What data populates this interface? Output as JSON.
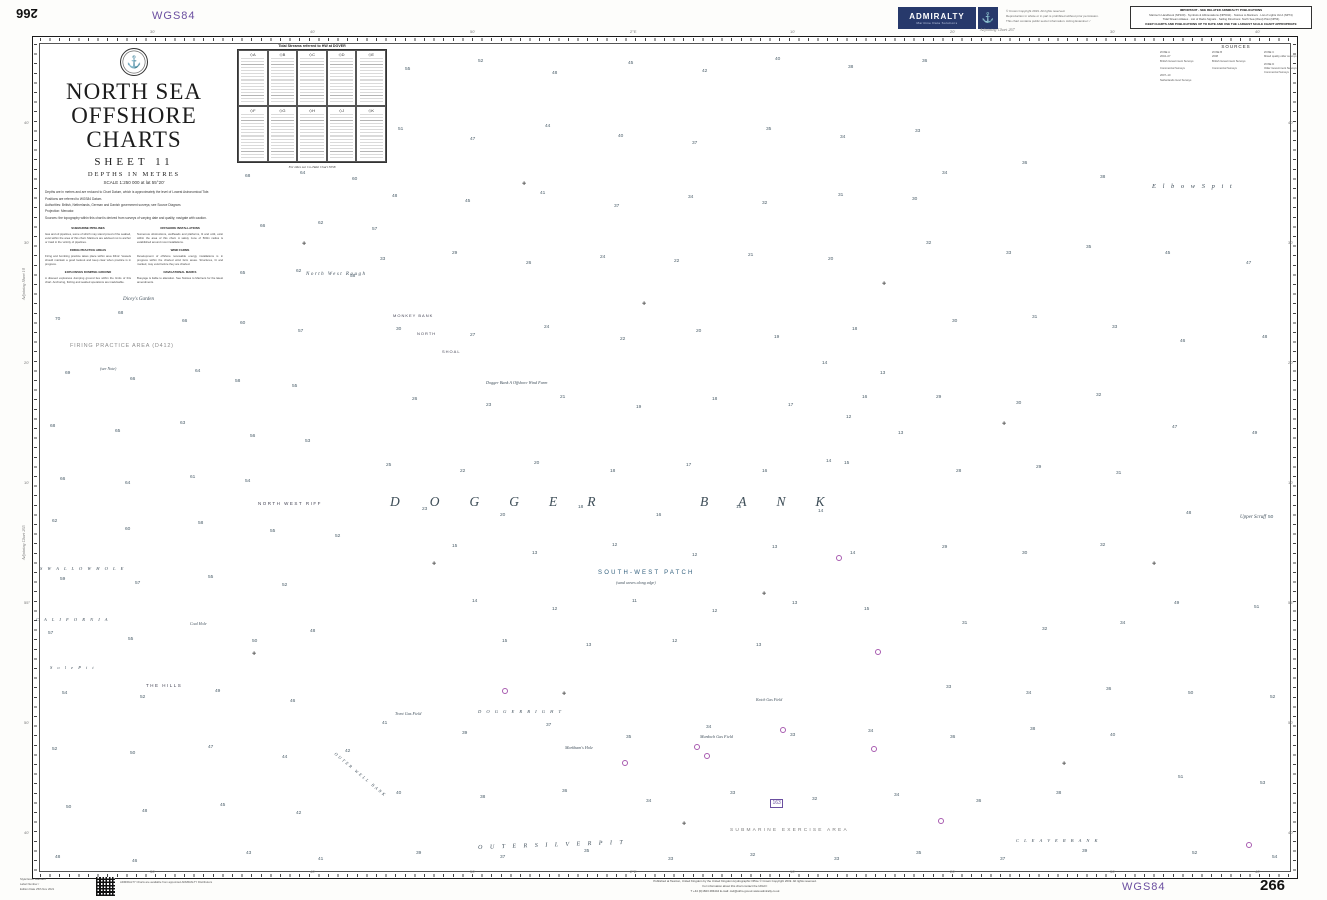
{
  "colors": {
    "navy": "#27396b",
    "purple": "#6b4fa0",
    "magenta": "#a85bb0",
    "w1": "#d9edf8",
    "w2": "#bfe2f4",
    "w3": "#a3d4ee"
  },
  "chart": {
    "number": "266",
    "datum": "WGS84",
    "title_line1": "NORTH SEA",
    "title_line2": "OFFSHORE CHARTS",
    "sheet": "SHEET  11",
    "depths": "DEPTHS IN METRES",
    "scale": "SCALE 1:250 000 at lat 55°20'",
    "notes_para": [
      "Depths are in metres and are reduced to Chart Datum, which is approximately the level of Lowest Astronomical Tide.",
      "Positions are referred to WGS84 Datum.",
      "Authorities: British, Netherlands, German and Danish government surveys; see Source Diagram.",
      "Projection: Mercator.",
      "Sources: the topography within this chart is derived from surveys of varying date and quality; navigate with caution."
    ],
    "notes_left": [
      {
        "h": "SUBMARINE PIPELINES",
        "b": "Gas and oil pipelines, some of which may stand proud of the seabed, exist within the area of this chart. Mariners are advised not to anchor or trawl in the vicinity of pipelines."
      },
      {
        "h": "FIRING PRACTICE AREAS",
        "b": "Firing and bombing practice takes place within area D412. Vessels should maintain a good lookout and keep clear when practice is in progress."
      },
      {
        "h": "EXPLOSIVES DUMPING GROUND",
        "b": "A disused explosives dumping ground lies within the limits of this chart. Anchoring, fishing and seabed operations are inadvisable."
      }
    ],
    "notes_right": [
      {
        "h": "OFFSHORE INSTALLATIONS",
        "b": "Numerous obstructions, wellheads and platforms, lit and unlit, exist within the area of this chart. A safety zone of 500m radius is established around most installations."
      },
      {
        "h": "WIND FARMS",
        "b": "Development of offshore renewable energy installations is in progress within the charted wind farm areas. Structures, lit and marked, may exist before they are charted."
      },
      {
        "h": "NAVIGATIONAL MARKS",
        "b": "Buoyage is liable to alteration. See Notices to Mariners for the latest amendments."
      }
    ]
  },
  "header": {
    "badge_label": "ADMIRALTY",
    "badge_sub": "Maritime Data Solutions",
    "anchor_glyph": "⚓",
    "copyright_lines": [
      "© Crown Copyright 2019. All rights reserved.",
      "Reproduction in whole or in part is prohibited without prior permission.",
      "This chart contains public sector information. Acting Examiner: /"
    ],
    "important": {
      "header": "IMPORTANT - SEE RELATED ADMIRALTY PUBLICATIONS",
      "lines": [
        "Mariner's Handbook (NP100) · Symbols & Abbreviations (NP5011) · Notices to Mariners · List of Lights Vol A (NP74)",
        "Tidal Stream Atlases · List of Radio Signals · Sailing Directions: North Sea (West) Pilot (NP54)"
      ],
      "footer": "KEEP CHARTS AND PUBLICATIONS UP TO DATE AND USE THE LARGEST SCALE CHART APPROPRIATE"
    }
  },
  "tidal_table": {
    "title": "Tidal Streams referred to HW at DOVER",
    "stations": [
      "A",
      "B",
      "C",
      "D",
      "E",
      "F",
      "G",
      "H",
      "J",
      "K"
    ],
    "footer": "For tides see Co-Tidal Chart 5058"
  },
  "sources": {
    "title": "SOURCES",
    "columns": [
      [
        "ZONE A",
        "2004–07",
        "British Government Surveys",
        "",
        "Commercial Surveys",
        "",
        "2007–10",
        "Netherlands Govt Surveys"
      ],
      [
        "ZONE B",
        "2008",
        "British Government Surveys",
        "",
        "Commercial Surveys"
      ],
      [
        "ZONE C",
        "Mixed quality older surveys",
        "",
        "ZONE D",
        "Older Government Surveys",
        "Commercial Surveys"
      ]
    ]
  },
  "footer": {
    "bottom_left_lines": [
      "Style/Issue      Standard",
      "Label Number   /",
      "Edition Date     25th Nov 2021"
    ],
    "qr_note": "ADMIRALTY Charts are available from appointed ADMIRALTY Distributors",
    "pub_lines": [
      "Published at Taunton, United Kingdom by the United Kingdom Hydrographic Office © Crown Copyright 2019. All rights reserved.",
      "For information about this chart contact the UKHO:",
      "T +44 (0)1823 484444          E-mail: csd@ukho.gov.uk          www.admiralty.co.uk"
    ]
  },
  "geo_labels": [
    {
      "t": "North West Rough",
      "x": 306,
      "y": 272,
      "c": "it5sp"
    },
    {
      "t": "MONKEY BANK",
      "x": 393,
      "y": 314,
      "c": "cap4"
    },
    {
      "t": "NORTH",
      "x": 417,
      "y": 332,
      "c": "cap4"
    },
    {
      "t": "SHOAL",
      "x": 442,
      "y": 350,
      "c": "cap4"
    },
    {
      "t": "Dicey's Garden",
      "x": 123,
      "y": 297,
      "c": "it5"
    },
    {
      "t": "FIRING PRACTICE AREA (D412)",
      "x": 70,
      "y": 344,
      "c": "area"
    },
    {
      "t": "(see Note)",
      "x": 100,
      "y": 367,
      "c": "it4"
    },
    {
      "t": "NORTH WEST RIFF",
      "x": 258,
      "y": 502,
      "c": "cap5sp"
    },
    {
      "t": "DOGGER",
      "x": 390,
      "y": 495,
      "c": "dogger"
    },
    {
      "t": "BANK",
      "x": 700,
      "y": 495,
      "c": "dogger"
    },
    {
      "t": "Dogger Bank A Offshore Wind Farm",
      "x": 486,
      "y": 381,
      "c": "it42"
    },
    {
      "t": "SOUTH-WEST PATCH",
      "x": 598,
      "y": 570,
      "c": "swp"
    },
    {
      "t": "(sand waves along edge)",
      "x": 616,
      "y": 581,
      "c": "it4"
    },
    {
      "t": "E l b o w   S p i t",
      "x": 1152,
      "y": 184,
      "c": "elbow"
    },
    {
      "t": "Upper Scruff",
      "x": 1240,
      "y": 515,
      "c": "it5"
    },
    {
      "t": "S W A L L O W   H O L E",
      "x": 40,
      "y": 567,
      "c": "itsp"
    },
    {
      "t": "C A L I F O R N I A",
      "x": 36,
      "y": 618,
      "c": "itsp"
    },
    {
      "t": "S o l e   P i t",
      "x": 50,
      "y": 666,
      "c": "itsp"
    },
    {
      "t": "Coal Hole",
      "x": 190,
      "y": 622,
      "c": "it4"
    },
    {
      "t": "THE HILLS",
      "x": 146,
      "y": 684,
      "c": "cap5sp"
    },
    {
      "t": "Trent Gas Field",
      "x": 395,
      "y": 712,
      "c": "it42"
    },
    {
      "t": "D O G G E R   B I G H T",
      "x": 478,
      "y": 710,
      "c": "itsp"
    },
    {
      "t": "Markham's Hole",
      "x": 565,
      "y": 746,
      "c": "it42"
    },
    {
      "t": "Murdoch Gas Field",
      "x": 700,
      "y": 735,
      "c": "it42"
    },
    {
      "t": "Ketch Gas Field",
      "x": 756,
      "y": 698,
      "c": "it4"
    },
    {
      "t": "SUBMARINE EXERCISE AREA",
      "x": 730,
      "y": 829,
      "c": "exer"
    },
    {
      "t": "O U T E R   S I L V E R   P I T",
      "x": 478,
      "y": 845,
      "c": "itsp6",
      "r": -2
    },
    {
      "t": "C L E A V E R   B A N K",
      "x": 1016,
      "y": 839,
      "c": "itsp"
    },
    {
      "t": "OUTER WELL BANK",
      "x": 336,
      "y": 752,
      "c": "cap4sp",
      "r": 40
    },
    {
      "t": "163",
      "x": 770,
      "y": 799,
      "c": "chartref"
    },
    {
      "t": "Adjoining Chart 267",
      "x": 980,
      "y": 28,
      "c": "adj"
    },
    {
      "t": "Adjoining Chart 265",
      "x": 22,
      "y": 560,
      "c": "adj",
      "r": -90
    },
    {
      "t": "Adjoining Sheet 10",
      "x": 22,
      "y": 300,
      "c": "adj",
      "r": -90
    }
  ],
  "border": {
    "top": [
      {
        "x": 150,
        "t": "30'"
      },
      {
        "x": 310,
        "t": "40'"
      },
      {
        "x": 470,
        "t": "50'"
      },
      {
        "x": 630,
        "t": "2°E"
      },
      {
        "x": 790,
        "t": "10'"
      },
      {
        "x": 950,
        "t": "20'"
      },
      {
        "x": 1110,
        "t": "30'"
      },
      {
        "x": 1255,
        "t": "40'"
      }
    ],
    "left": [
      {
        "y": 120,
        "t": "40'"
      },
      {
        "y": 240,
        "t": "30'"
      },
      {
        "y": 360,
        "t": "20'"
      },
      {
        "y": 480,
        "t": "10'"
      },
      {
        "y": 600,
        "t": "55°"
      },
      {
        "y": 720,
        "t": "50'"
      },
      {
        "y": 830,
        "t": "40'"
      }
    ]
  },
  "symbols": {
    "wrecks": [
      [
        302,
        242
      ],
      [
        522,
        182
      ],
      [
        642,
        302
      ],
      [
        432,
        562
      ],
      [
        762,
        592
      ],
      [
        562,
        692
      ],
      [
        882,
        282
      ],
      [
        1002,
        422
      ],
      [
        1152,
        562
      ],
      [
        252,
        652
      ],
      [
        682,
        822
      ],
      [
        1062,
        762
      ]
    ],
    "platforms": [
      [
        836,
        555
      ],
      [
        875,
        649
      ],
      [
        694,
        744
      ],
      [
        704,
        753
      ],
      [
        780,
        727
      ],
      [
        871,
        746
      ],
      [
        938,
        818
      ],
      [
        502,
        688
      ],
      [
        622,
        760
      ],
      [
        1246,
        842
      ]
    ]
  },
  "soundings": [
    [
      245,
      175,
      "68"
    ],
    [
      300,
      172,
      "64"
    ],
    [
      352,
      178,
      "60"
    ],
    [
      260,
      225,
      "66"
    ],
    [
      318,
      222,
      "62"
    ],
    [
      372,
      228,
      "57"
    ],
    [
      240,
      272,
      "65"
    ],
    [
      296,
      270,
      "62"
    ],
    [
      350,
      275,
      "58"
    ],
    [
      55,
      318,
      "70"
    ],
    [
      118,
      312,
      "68"
    ],
    [
      182,
      320,
      "66"
    ],
    [
      65,
      372,
      "69"
    ],
    [
      130,
      378,
      "66"
    ],
    [
      195,
      370,
      "64"
    ],
    [
      50,
      425,
      "68"
    ],
    [
      115,
      430,
      "65"
    ],
    [
      180,
      422,
      "63"
    ],
    [
      60,
      478,
      "66"
    ],
    [
      125,
      482,
      "64"
    ],
    [
      190,
      476,
      "61"
    ],
    [
      240,
      322,
      "60"
    ],
    [
      298,
      330,
      "57"
    ],
    [
      235,
      380,
      "58"
    ],
    [
      292,
      385,
      "55"
    ],
    [
      250,
      435,
      "56"
    ],
    [
      305,
      440,
      "53"
    ],
    [
      245,
      480,
      "54"
    ],
    [
      52,
      520,
      "62"
    ],
    [
      125,
      528,
      "60"
    ],
    [
      198,
      522,
      "58"
    ],
    [
      270,
      530,
      "55"
    ],
    [
      335,
      535,
      "52"
    ],
    [
      60,
      578,
      "59"
    ],
    [
      135,
      582,
      "57"
    ],
    [
      208,
      576,
      "55"
    ],
    [
      282,
      584,
      "52"
    ],
    [
      48,
      632,
      "57"
    ],
    [
      128,
      638,
      "55"
    ],
    [
      252,
      640,
      "50"
    ],
    [
      310,
      630,
      "48"
    ],
    [
      62,
      692,
      "54"
    ],
    [
      140,
      696,
      "52"
    ],
    [
      215,
      690,
      "49"
    ],
    [
      290,
      700,
      "46"
    ],
    [
      52,
      748,
      "52"
    ],
    [
      130,
      752,
      "50"
    ],
    [
      208,
      746,
      "47"
    ],
    [
      282,
      756,
      "44"
    ],
    [
      345,
      750,
      "42"
    ],
    [
      66,
      806,
      "50"
    ],
    [
      142,
      810,
      "48"
    ],
    [
      220,
      804,
      "45"
    ],
    [
      296,
      812,
      "42"
    ],
    [
      55,
      856,
      "48"
    ],
    [
      132,
      860,
      "46"
    ],
    [
      246,
      852,
      "43"
    ],
    [
      318,
      858,
      "41"
    ],
    [
      405,
      68,
      "55"
    ],
    [
      478,
      60,
      "52"
    ],
    [
      552,
      72,
      "48"
    ],
    [
      628,
      62,
      "45"
    ],
    [
      702,
      70,
      "42"
    ],
    [
      775,
      58,
      "40"
    ],
    [
      848,
      66,
      "38"
    ],
    [
      922,
      60,
      "36"
    ],
    [
      398,
      128,
      "51"
    ],
    [
      470,
      138,
      "47"
    ],
    [
      545,
      125,
      "44"
    ],
    [
      618,
      135,
      "40"
    ],
    [
      692,
      142,
      "37"
    ],
    [
      766,
      128,
      "35"
    ],
    [
      840,
      136,
      "34"
    ],
    [
      915,
      130,
      "33"
    ],
    [
      392,
      195,
      "48"
    ],
    [
      465,
      200,
      "45"
    ],
    [
      540,
      192,
      "41"
    ],
    [
      614,
      205,
      "37"
    ],
    [
      688,
      196,
      "34"
    ],
    [
      762,
      202,
      "32"
    ],
    [
      838,
      194,
      "31"
    ],
    [
      912,
      198,
      "30"
    ],
    [
      380,
      258,
      "33"
    ],
    [
      452,
      252,
      "29"
    ],
    [
      526,
      262,
      "26"
    ],
    [
      600,
      256,
      "24"
    ],
    [
      674,
      260,
      "22"
    ],
    [
      748,
      254,
      "21"
    ],
    [
      828,
      258,
      "20"
    ],
    [
      396,
      328,
      "30"
    ],
    [
      470,
      334,
      "27"
    ],
    [
      544,
      326,
      "24"
    ],
    [
      620,
      338,
      "22"
    ],
    [
      696,
      330,
      "20"
    ],
    [
      774,
      336,
      "19"
    ],
    [
      852,
      328,
      "18"
    ],
    [
      412,
      398,
      "26"
    ],
    [
      486,
      404,
      "23"
    ],
    [
      560,
      396,
      "21"
    ],
    [
      636,
      406,
      "19"
    ],
    [
      712,
      398,
      "18"
    ],
    [
      788,
      404,
      "17"
    ],
    [
      862,
      396,
      "16"
    ],
    [
      386,
      464,
      "25"
    ],
    [
      460,
      470,
      "22"
    ],
    [
      534,
      462,
      "20"
    ],
    [
      610,
      470,
      "18"
    ],
    [
      686,
      464,
      "17"
    ],
    [
      762,
      470,
      "16"
    ],
    [
      844,
      462,
      "15"
    ],
    [
      422,
      508,
      "23"
    ],
    [
      500,
      514,
      "20"
    ],
    [
      578,
      506,
      "18"
    ],
    [
      656,
      514,
      "16"
    ],
    [
      736,
      506,
      "15"
    ],
    [
      818,
      510,
      "14"
    ],
    [
      452,
      545,
      "15"
    ],
    [
      532,
      552,
      "13"
    ],
    [
      612,
      544,
      "12"
    ],
    [
      692,
      554,
      "12"
    ],
    [
      772,
      546,
      "13"
    ],
    [
      850,
      552,
      "14"
    ],
    [
      472,
      600,
      "14"
    ],
    [
      552,
      608,
      "12"
    ],
    [
      632,
      600,
      "11"
    ],
    [
      712,
      610,
      "12"
    ],
    [
      792,
      602,
      "13"
    ],
    [
      864,
      608,
      "15"
    ],
    [
      502,
      640,
      "15"
    ],
    [
      586,
      644,
      "13"
    ],
    [
      672,
      640,
      "12"
    ],
    [
      756,
      644,
      "13"
    ],
    [
      822,
      362,
      "14"
    ],
    [
      880,
      372,
      "13"
    ],
    [
      846,
      416,
      "12"
    ],
    [
      898,
      432,
      "13"
    ],
    [
      826,
      460,
      "14"
    ],
    [
      942,
      172,
      "34"
    ],
    [
      1022,
      162,
      "36"
    ],
    [
      1100,
      176,
      "38"
    ],
    [
      926,
      242,
      "32"
    ],
    [
      1006,
      252,
      "33"
    ],
    [
      1086,
      246,
      "35"
    ],
    [
      952,
      320,
      "30"
    ],
    [
      1032,
      316,
      "31"
    ],
    [
      1112,
      326,
      "33"
    ],
    [
      936,
      396,
      "29"
    ],
    [
      1016,
      402,
      "30"
    ],
    [
      1096,
      394,
      "32"
    ],
    [
      956,
      470,
      "28"
    ],
    [
      1036,
      466,
      "29"
    ],
    [
      1116,
      472,
      "31"
    ],
    [
      942,
      546,
      "29"
    ],
    [
      1022,
      552,
      "30"
    ],
    [
      1100,
      544,
      "32"
    ],
    [
      962,
      622,
      "31"
    ],
    [
      1042,
      628,
      "32"
    ],
    [
      1120,
      622,
      "34"
    ],
    [
      946,
      686,
      "33"
    ],
    [
      1026,
      692,
      "34"
    ],
    [
      1106,
      688,
      "36"
    ],
    [
      1165,
      252,
      "45"
    ],
    [
      1246,
      262,
      "47"
    ],
    [
      1180,
      340,
      "46"
    ],
    [
      1262,
      336,
      "48"
    ],
    [
      1172,
      426,
      "47"
    ],
    [
      1252,
      432,
      "49"
    ],
    [
      1186,
      512,
      "48"
    ],
    [
      1268,
      516,
      "50"
    ],
    [
      1174,
      602,
      "49"
    ],
    [
      1254,
      606,
      "51"
    ],
    [
      1188,
      692,
      "50"
    ],
    [
      1270,
      696,
      "52"
    ],
    [
      1178,
      776,
      "51"
    ],
    [
      1260,
      782,
      "53"
    ],
    [
      1192,
      852,
      "52"
    ],
    [
      1272,
      856,
      "54"
    ],
    [
      382,
      722,
      "41"
    ],
    [
      462,
      732,
      "39"
    ],
    [
      546,
      724,
      "37"
    ],
    [
      626,
      736,
      "35"
    ],
    [
      706,
      726,
      "34"
    ],
    [
      790,
      734,
      "33"
    ],
    [
      868,
      730,
      "34"
    ],
    [
      950,
      736,
      "36"
    ],
    [
      1030,
      728,
      "38"
    ],
    [
      1110,
      734,
      "40"
    ],
    [
      396,
      792,
      "40"
    ],
    [
      480,
      796,
      "38"
    ],
    [
      562,
      790,
      "36"
    ],
    [
      646,
      800,
      "34"
    ],
    [
      730,
      792,
      "33"
    ],
    [
      812,
      798,
      "32"
    ],
    [
      894,
      794,
      "34"
    ],
    [
      976,
      800,
      "36"
    ],
    [
      1056,
      792,
      "38"
    ],
    [
      416,
      852,
      "39"
    ],
    [
      500,
      856,
      "37"
    ],
    [
      584,
      850,
      "35"
    ],
    [
      668,
      858,
      "33"
    ],
    [
      750,
      854,
      "32"
    ],
    [
      834,
      858,
      "33"
    ],
    [
      916,
      852,
      "35"
    ],
    [
      1000,
      858,
      "37"
    ],
    [
      1082,
      850,
      "39"
    ]
  ]
}
